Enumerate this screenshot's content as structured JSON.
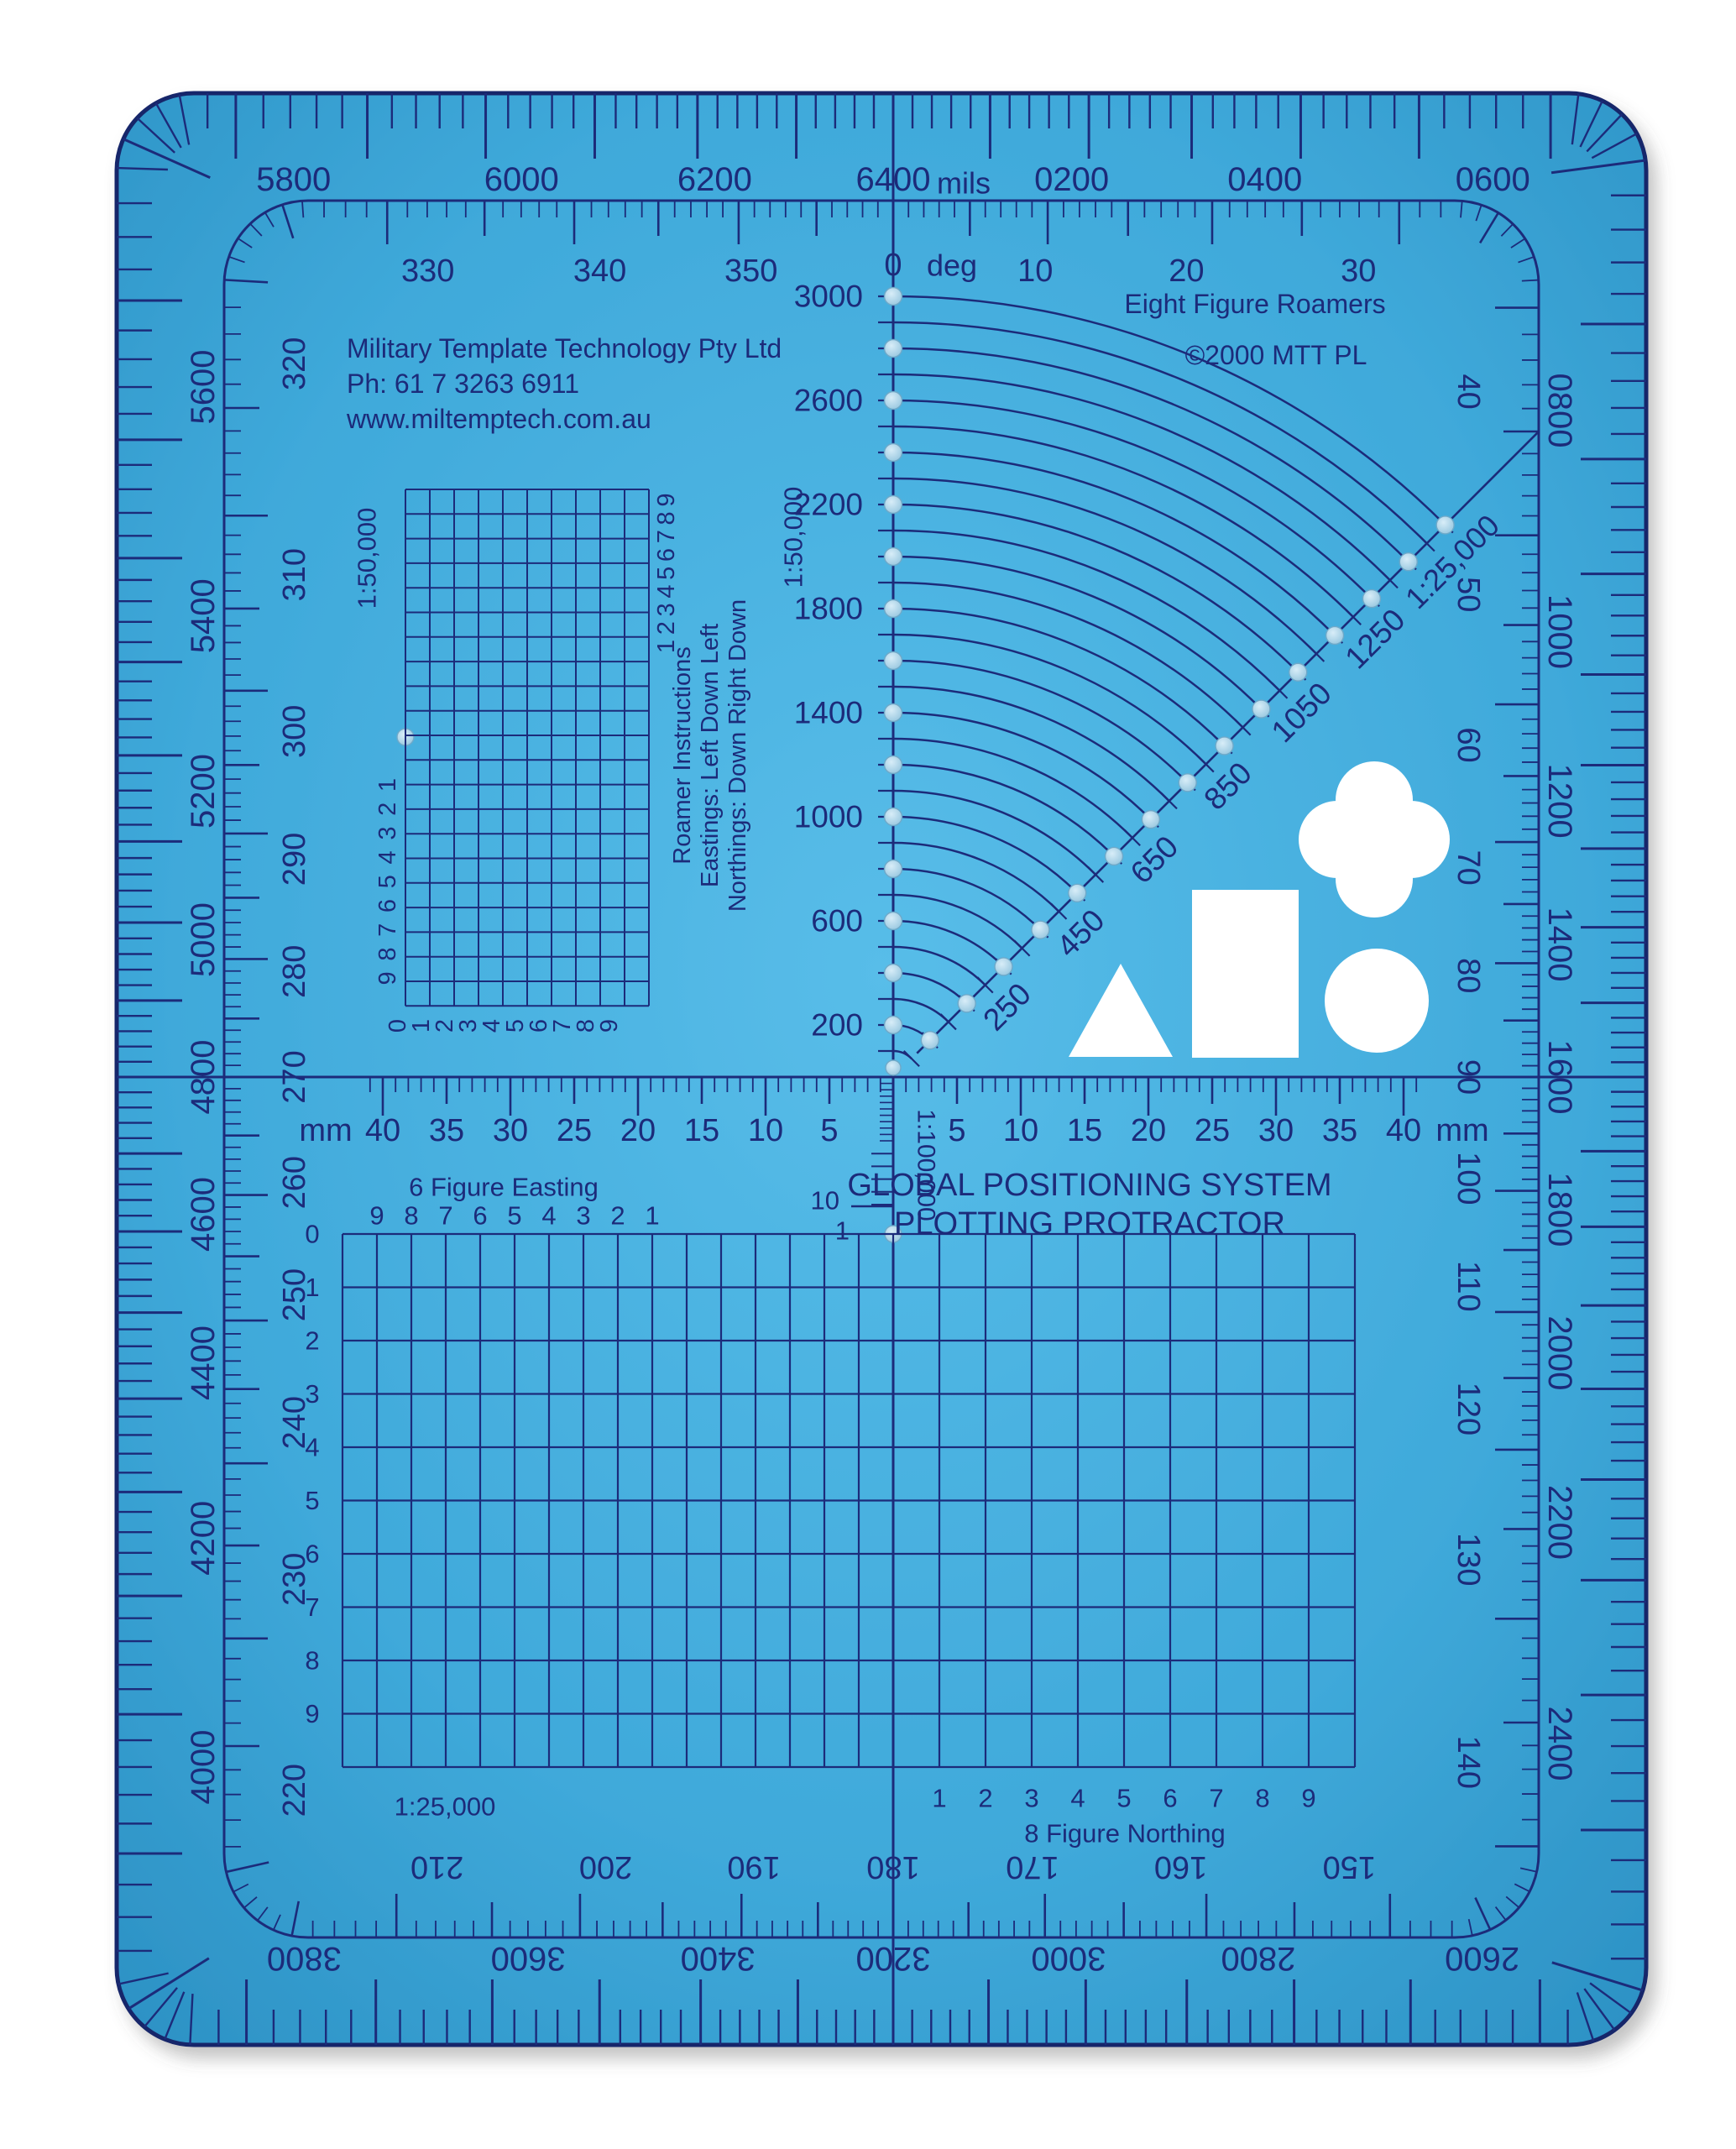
{
  "product": {
    "company_lines": [
      "Military Template Technology Pty Ltd",
      "Ph: 61 7 3263 6911",
      "www.miltemptech.com.au"
    ],
    "roamers_title": "Eight Figure Roamers",
    "copyright": "©2000 MTT PL",
    "main_title_line1": "GLOBAL POSITIONING SYSTEM",
    "main_title_line2": "PLOTTING PROTRACTOR"
  },
  "colors": {
    "background": "#ffffff",
    "plastic": "#3fa9da",
    "plastic_light": "#58bde9",
    "plastic_dark": "#2b90c3",
    "ink": "#1c2b7a",
    "bead_light": "#d8edf8",
    "bead_dark": "#8fc2dc",
    "cutout": "#ffffff"
  },
  "border_mils_scale": {
    "unit_label": "mils",
    "label_step": 200,
    "major_tick_step": 100,
    "minor_tick_step": 20,
    "full_circle": 6400,
    "labels": [
      "0200",
      "0400",
      "0600",
      "0800",
      "1000",
      "1200",
      "1400",
      "1600",
      "1800",
      "2000",
      "2200",
      "2400",
      "2600",
      "2800",
      "3000",
      "3200",
      "3400",
      "3600",
      "3800",
      "4000",
      "4200",
      "4400",
      "4600",
      "4800",
      "5000",
      "5200",
      "5400",
      "5600",
      "5800",
      "6000",
      "6200",
      "6400"
    ]
  },
  "degree_ring": {
    "zero_label": "0 deg",
    "label_step": 10,
    "major_tick_step": 5,
    "minor_tick_step": 1,
    "labels": [
      "10",
      "20",
      "30",
      "40",
      "50",
      "60",
      "70",
      "80",
      "90",
      "100",
      "110",
      "120",
      "130",
      "140",
      "150",
      "160",
      "170",
      "180",
      "190",
      "200",
      "210",
      "220",
      "230",
      "240",
      "250",
      "260",
      "270",
      "280",
      "290",
      "300",
      "310",
      "320",
      "330",
      "340",
      "350"
    ]
  },
  "arc_fan": {
    "arc_count": 30,
    "axis_scale_label": "1:50,000",
    "axis_labels": [
      "200",
      "600",
      "1000",
      "1400",
      "1800",
      "2200",
      "2600",
      "3000"
    ],
    "diagonal_scale_label": "1:25,000",
    "diagonal_labels": [
      "250",
      "450",
      "650",
      "850",
      "1050",
      "1250"
    ]
  },
  "mm_ruler": {
    "unit_label": "mm",
    "labels_left": [
      "40",
      "35",
      "30",
      "25",
      "20",
      "15",
      "10",
      "5"
    ],
    "labels_right": [
      "5",
      "10",
      "15",
      "20",
      "25",
      "30",
      "35",
      "40"
    ]
  },
  "roamer_100k": {
    "scale_label": "1:100,000",
    "end_labels": [
      "10",
      "1"
    ]
  },
  "roamer_50k": {
    "scale_label": "1:50,000",
    "right_digits": [
      "1",
      "2",
      "3",
      "4",
      "5",
      "6",
      "7",
      "8",
      "9"
    ],
    "left_digits": [
      "1",
      "2",
      "3",
      "4",
      "5",
      "6",
      "7",
      "8",
      "9"
    ],
    "bottom_digits": [
      "0",
      "1",
      "2",
      "3",
      "4",
      "5",
      "6",
      "7",
      "8",
      "9"
    ],
    "instructions": [
      "Roamer Instructions",
      "Eastings: Left Down Left",
      "Northings: Down Right Down"
    ]
  },
  "bottom_grid": {
    "easting_title": "6 Figure Easting",
    "easting_cols": [
      "9",
      "8",
      "7",
      "6",
      "5",
      "4",
      "3",
      "2",
      "1"
    ],
    "row_labels": [
      "0",
      "1",
      "2",
      "3",
      "4",
      "5",
      "6",
      "7",
      "8",
      "9"
    ],
    "northing_title": "8 Figure Northing",
    "northing_cols": [
      "1",
      "2",
      "3",
      "4",
      "5",
      "6",
      "7",
      "8",
      "9"
    ],
    "scale_label": "1:25,000"
  }
}
